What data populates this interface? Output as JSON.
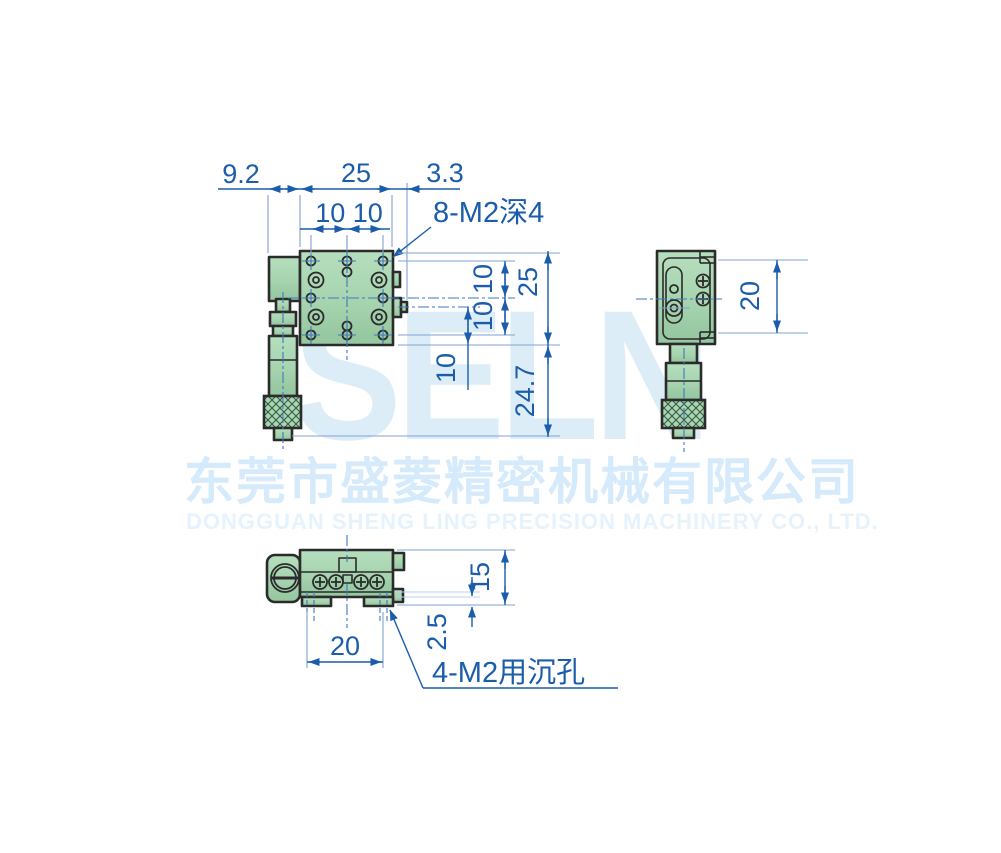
{
  "watermark": {
    "logo": "SELN",
    "company_cn": "东莞市盛菱精密机械有限公司",
    "company_en": "DONGGUAN SHENG LING PRECISION MACHINERY CO., LTD."
  },
  "drawing": {
    "front_view": {
      "dim_width_left": "9.2",
      "dim_width_plate": "25",
      "dim_width_right": "3.3",
      "dim_hole_spacing_top": "10 10",
      "thread_label": "8-M2深4",
      "dim_row_upper": "10",
      "dim_row_lower": "10",
      "dim_inner": "10",
      "dim_height_plate": "25",
      "dim_height_micrometer": "24.7"
    },
    "side_view": {
      "dim_mount_spacing": "20"
    },
    "bottom_view": {
      "dim_height": "15",
      "dim_foot_offset": "2.5",
      "dim_mount_spacing": "20",
      "cbore_label": "4-M2用沉孔"
    }
  },
  "colors": {
    "dimension_blue": "#1b5cab",
    "body_green": "#a9d6b2",
    "outline_dark": "#2b2b2b",
    "watermark_blue": "#dcedf8"
  }
}
